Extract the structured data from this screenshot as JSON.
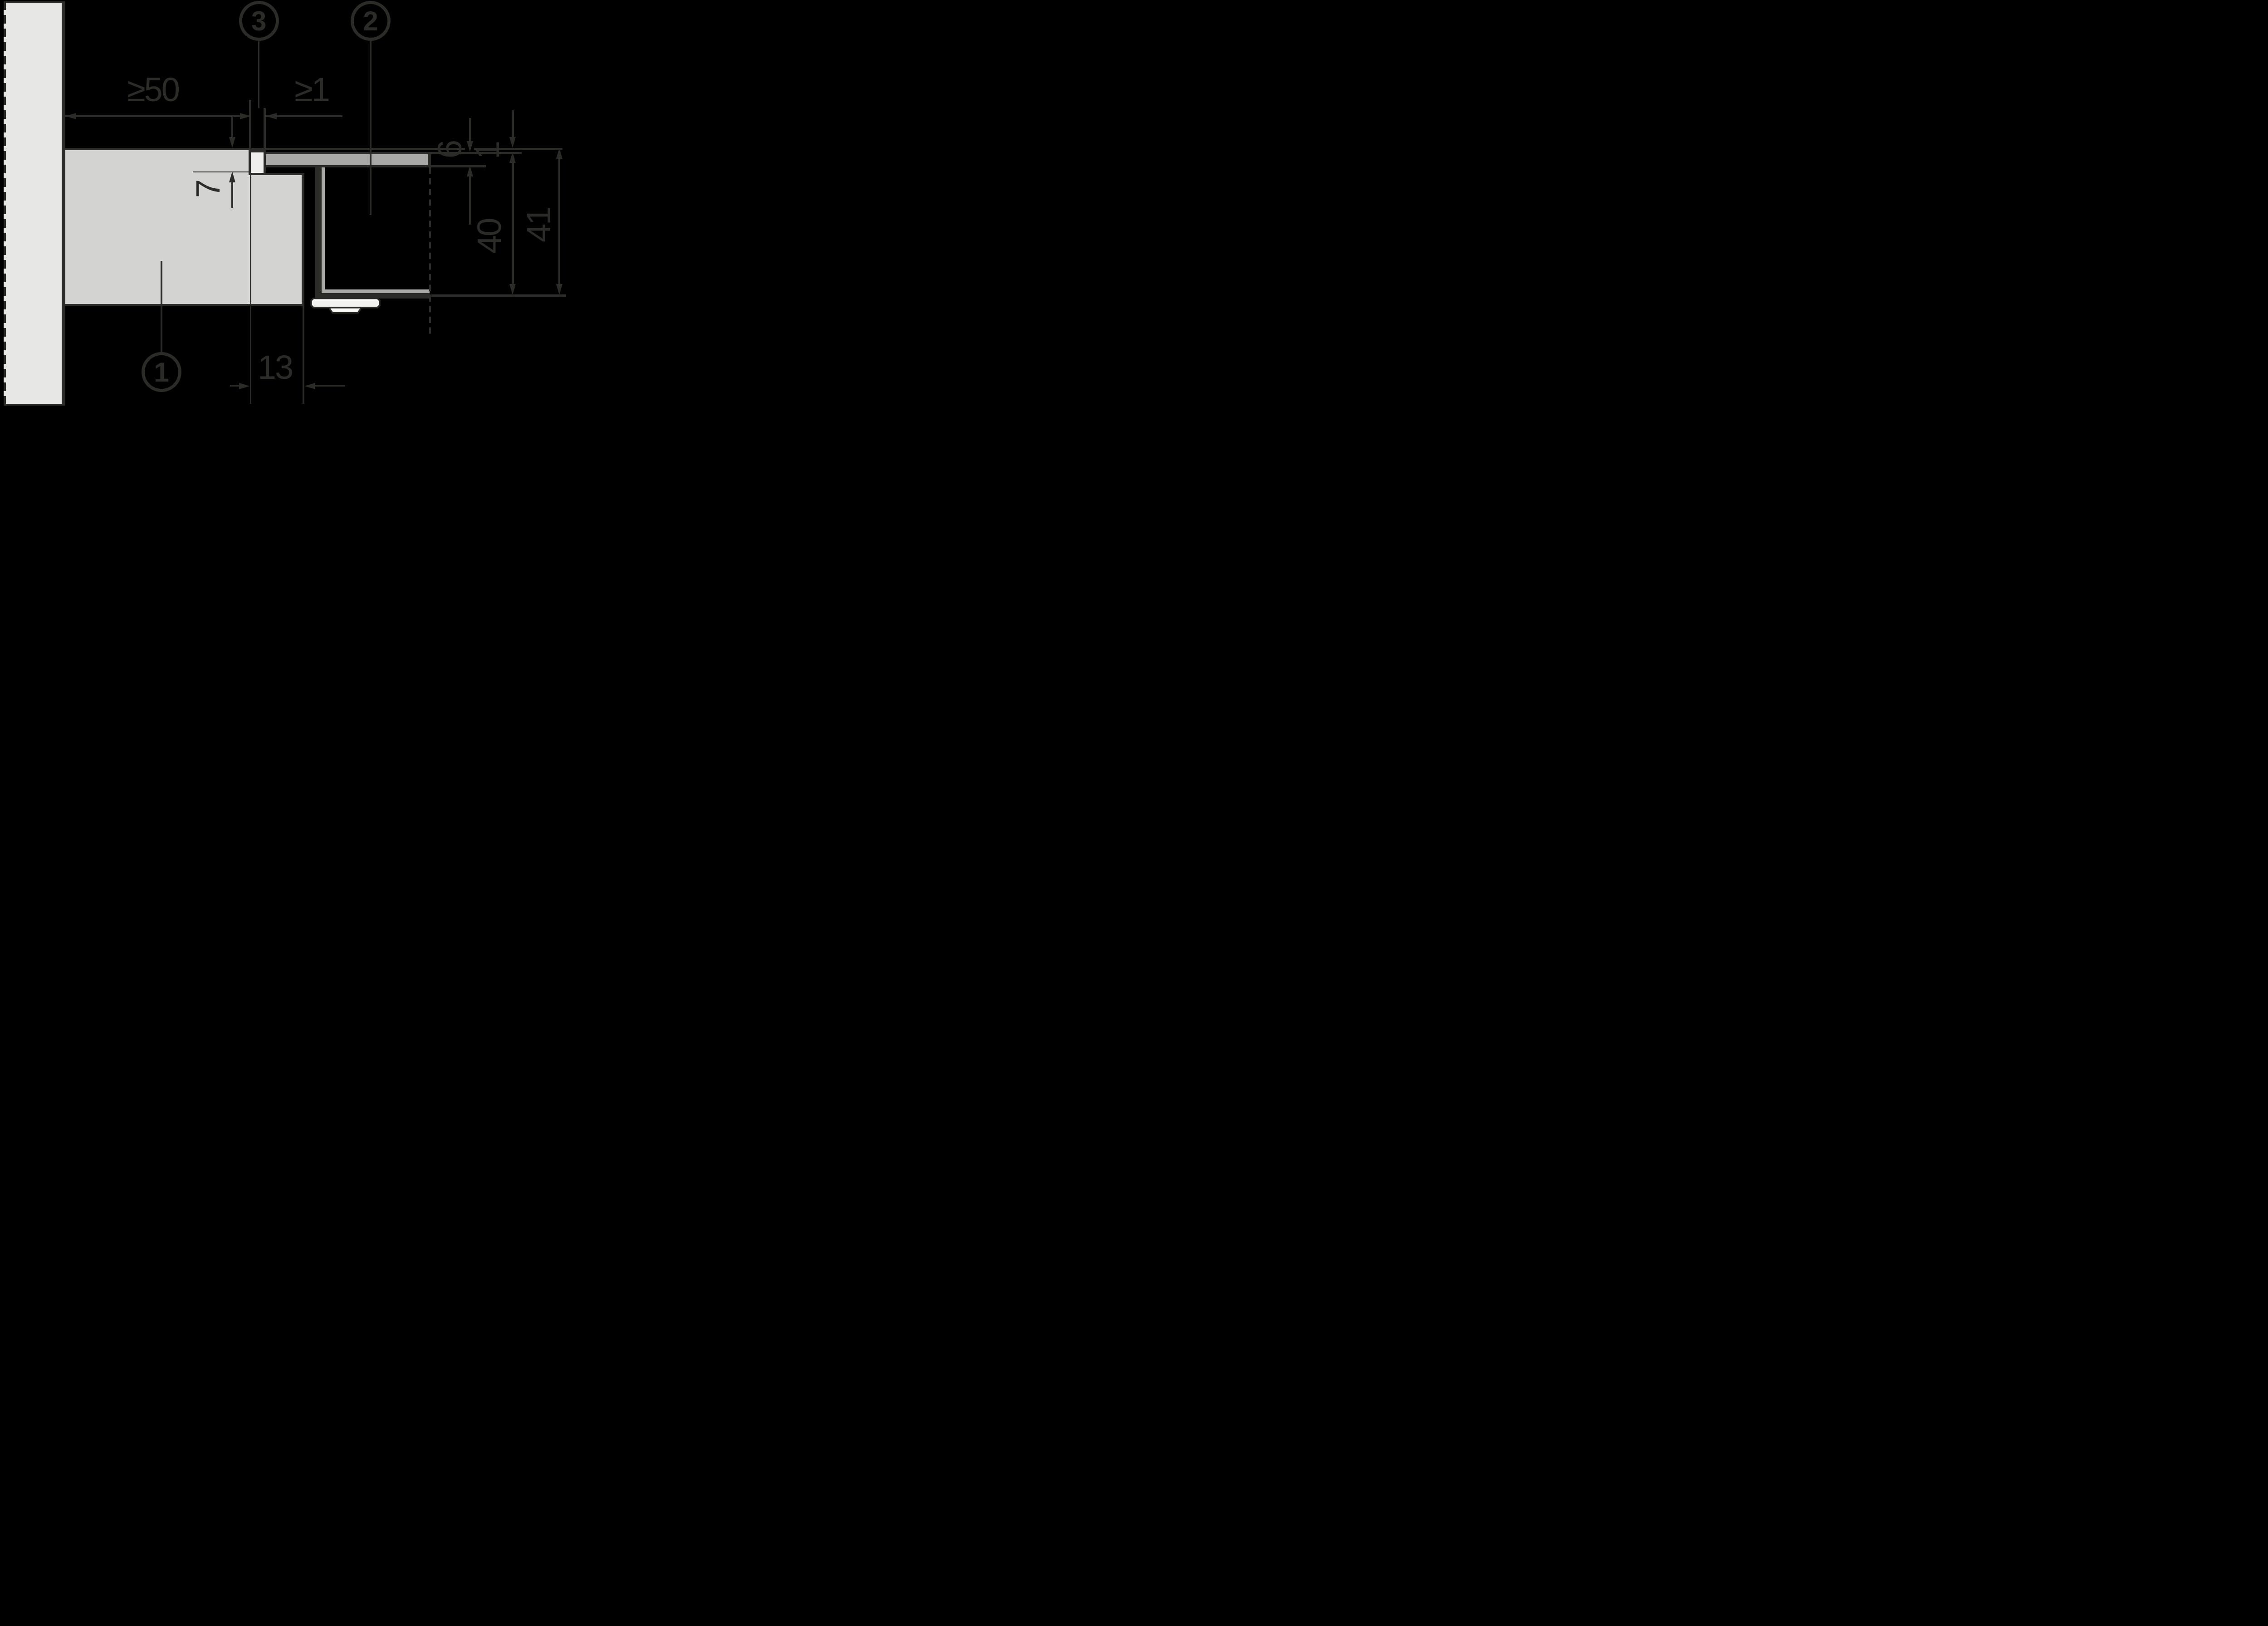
{
  "colors": {
    "background": "#000000",
    "ink": "#2b2b28",
    "wall": "#e7e7e6",
    "countertop": "#d3d3d2",
    "front_panel": "#a9a9a8",
    "seal_strip": "#eeeeec",
    "bracket_body": "#f2f2f0",
    "bracket_foot": "#fdfdfc"
  },
  "callouts": {
    "countertop": "1",
    "front_panel": "2",
    "seal_strip": "3"
  },
  "dimensions": {
    "wall_clearance": "≥50",
    "front_gap": "≥1",
    "panel_thickness": "6",
    "top_gap": "1",
    "notch_depth": "7",
    "notch_width": "13",
    "inner_height": "40",
    "outer_height": "41"
  }
}
